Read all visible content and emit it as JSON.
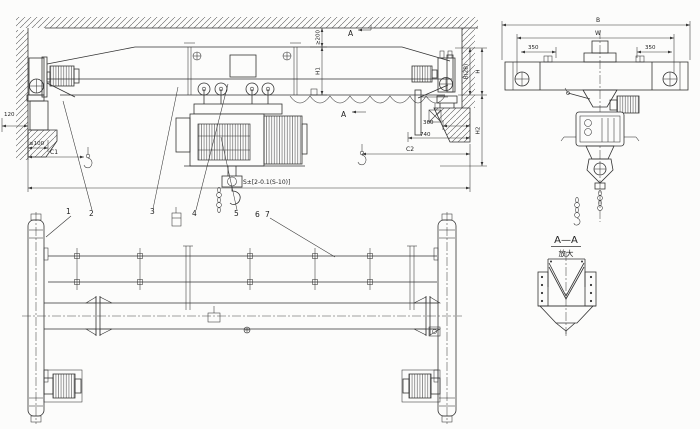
{
  "drawing": {
    "kind": "single-girder-overhead-crane-outline-drawing",
    "elevation": {
      "dim_120": "120",
      "dim_ge100": "≥100",
      "dim_c1": "C1",
      "dim_ge200": "≥200",
      "dim_h1": "H1",
      "dim_b2b": "B(2B)",
      "dim_h": "H",
      "dim_h2": "H2",
      "dim_360": "360",
      "dim_740": "740",
      "dim_c2": "C2",
      "dim_span": "S±[2-0.1(S-10)]",
      "section_mark": "A",
      "callouts": [
        "1",
        "2",
        "3",
        "4",
        "5",
        "6",
        "7"
      ]
    },
    "end_view": {
      "dim_b": "B",
      "dim_w": "W",
      "dim_350_left": "350",
      "dim_350_right": "350"
    },
    "detail": {
      "title": "A—A",
      "subtitle": "放大"
    },
    "colors": {
      "ink": "#333333",
      "paper": "#fcfcfb"
    }
  }
}
